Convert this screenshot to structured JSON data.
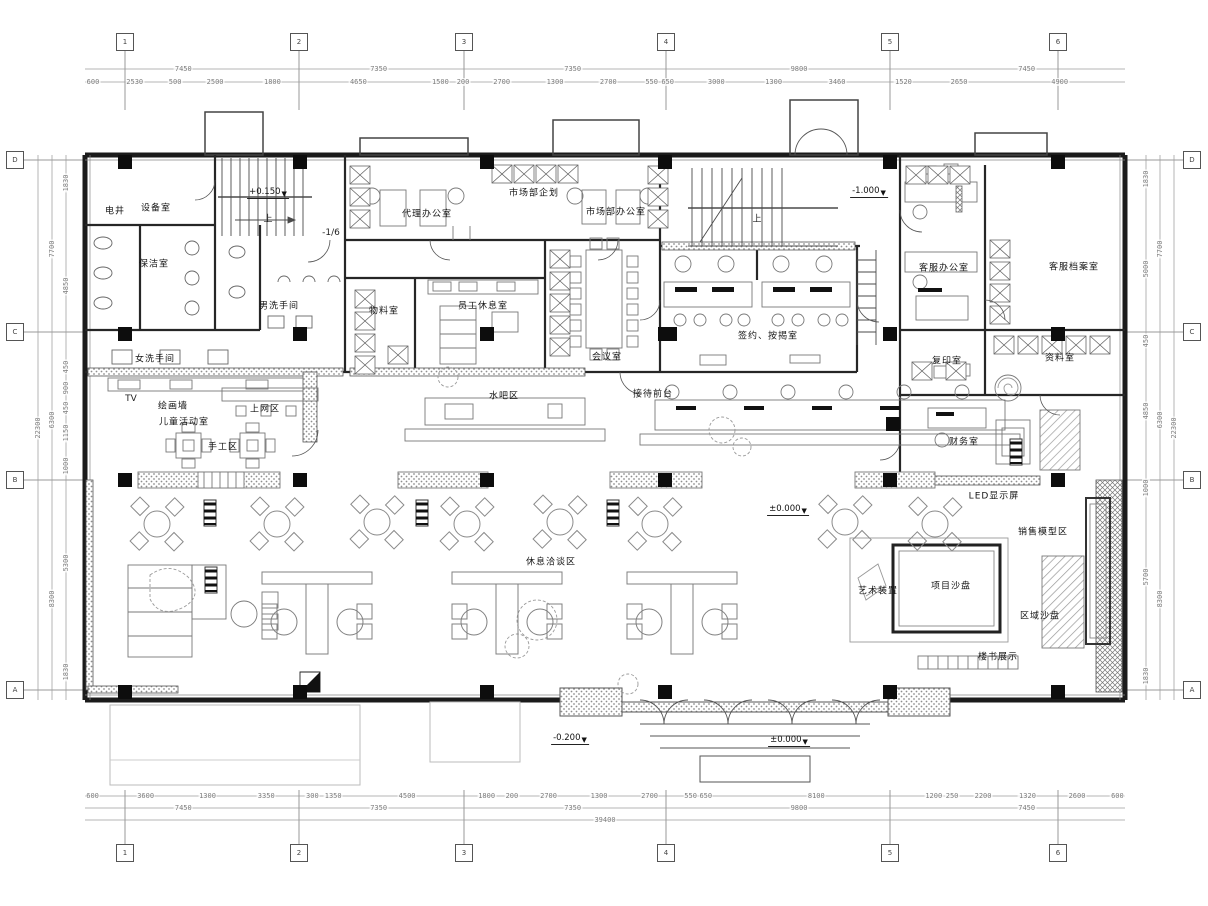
{
  "symbols": {
    "elevation_marker": "▼"
  },
  "rooms": [
    {
      "t": "电井",
      "x": 115,
      "y": 210
    },
    {
      "t": "设备室",
      "x": 156,
      "y": 207
    },
    {
      "t": "保洁室",
      "x": 154,
      "y": 263
    },
    {
      "t": "男洗手间",
      "x": 279,
      "y": 305
    },
    {
      "t": "女洗手间",
      "x": 155,
      "y": 358
    },
    {
      "t": "绘画墙",
      "x": 173,
      "y": 405
    },
    {
      "t": "儿童活动室",
      "x": 184,
      "y": 421
    },
    {
      "t": "上网区",
      "x": 265,
      "y": 408
    },
    {
      "t": "手工区",
      "x": 223,
      "y": 446
    },
    {
      "t": "物料室",
      "x": 384,
      "y": 310
    },
    {
      "t": "员工休息室",
      "x": 483,
      "y": 305
    },
    {
      "t": "代理办公室",
      "x": 427,
      "y": 213
    },
    {
      "t": "市场部企划",
      "x": 534,
      "y": 192
    },
    {
      "t": "市场部办公室",
      "x": 616,
      "y": 211
    },
    {
      "t": "会议室",
      "x": 607,
      "y": 356
    },
    {
      "t": "签约、按揭室",
      "x": 768,
      "y": 335
    },
    {
      "t": "客服办公室",
      "x": 944,
      "y": 267
    },
    {
      "t": "客服档案室",
      "x": 1074,
      "y": 266
    },
    {
      "t": "复印室",
      "x": 947,
      "y": 360
    },
    {
      "t": "资料室",
      "x": 1060,
      "y": 357
    },
    {
      "t": "财务室",
      "x": 964,
      "y": 441
    },
    {
      "t": "LED显示屏",
      "x": 994,
      "y": 495
    },
    {
      "t": "销售模型区",
      "x": 1043,
      "y": 531
    },
    {
      "t": "艺术装置",
      "x": 878,
      "y": 590
    },
    {
      "t": "项目沙盘",
      "x": 951,
      "y": 585
    },
    {
      "t": "区域沙盘",
      "x": 1040,
      "y": 615
    },
    {
      "t": "楼书展示",
      "x": 998,
      "y": 656
    },
    {
      "t": "水吧区",
      "x": 504,
      "y": 395
    },
    {
      "t": "接待前台",
      "x": 653,
      "y": 393
    },
    {
      "t": "休息洽谈区",
      "x": 551,
      "y": 561
    }
  ],
  "annotations": [
    {
      "t": "上",
      "x": 268,
      "y": 218
    },
    {
      "t": "上",
      "x": 757,
      "y": 218
    },
    {
      "t": "TV",
      "x": 131,
      "y": 399
    },
    {
      "t": "-1/6",
      "x": 331,
      "y": 233
    }
  ],
  "elevations": [
    {
      "t": "+0.150",
      "x": 268,
      "y": 199
    },
    {
      "t": "-1.000",
      "x": 869,
      "y": 198
    },
    {
      "t": "±0.000",
      "x": 788,
      "y": 516
    },
    {
      "t": "-0.200",
      "x": 570,
      "y": 745
    },
    {
      "t": "±0.000",
      "x": 789,
      "y": 747
    }
  ],
  "dimensions": {
    "rows": [
      {
        "id": "top-segments",
        "dir": "h",
        "x": 85,
        "y": 82,
        "len": 1040,
        "values": [
          600,
          2530,
          500,
          2500,
          1800,
          4650,
          1500,
          200,
          2700,
          1300,
          2700,
          550,
          650,
          3000,
          1300,
          3460,
          1520,
          2650,
          4900
        ]
      },
      {
        "id": "top-bays",
        "dir": "h",
        "x": 85,
        "y": 69,
        "len": 1040,
        "values": [
          7450,
          7350,
          7350,
          9800,
          7450
        ]
      },
      {
        "id": "bottom-segments",
        "dir": "h",
        "x": 85,
        "y": 796,
        "len": 1040,
        "values": [
          600,
          3600,
          1300,
          3350,
          300,
          1350,
          4500,
          1800,
          200,
          2700,
          1300,
          2700,
          550,
          650,
          8100,
          1200,
          250,
          2200,
          1320,
          2600,
          600
        ]
      },
      {
        "id": "bottom-bays",
        "dir": "h",
        "x": 85,
        "y": 808,
        "len": 1040,
        "values": [
          7450,
          7350,
          7350,
          9800,
          7450
        ]
      },
      {
        "id": "bottom-total",
        "dir": "h",
        "x": 85,
        "y": 820,
        "len": 1040,
        "values": [
          39400
        ]
      },
      {
        "id": "left-segments",
        "dir": "v",
        "x": 66,
        "y": 155,
        "len": 545,
        "values": [
          1830,
          4850,
          450,
          900,
          450,
          1150,
          1000,
          5300,
          1830
        ]
      },
      {
        "id": "left-bays",
        "dir": "v",
        "x": 52,
        "y": 155,
        "len": 545,
        "values": [
          7700,
          6300,
          8300
        ]
      },
      {
        "id": "left-total",
        "dir": "v",
        "x": 38,
        "y": 155,
        "len": 545,
        "values": [
          22300
        ]
      },
      {
        "id": "right-segments",
        "dir": "v",
        "x": 1146,
        "y": 155,
        "len": 545,
        "values": [
          1830,
          5000,
          450,
          4850,
          1000,
          5700,
          1830
        ]
      },
      {
        "id": "right-bays",
        "dir": "v",
        "x": 1160,
        "y": 155,
        "len": 545,
        "values": [
          7700,
          6300,
          8300
        ]
      },
      {
        "id": "right-total",
        "dir": "v",
        "x": 1174,
        "y": 155,
        "len": 545,
        "values": [
          22300
        ]
      }
    ]
  },
  "grid": {
    "rows": [
      {
        "id": "axes-top",
        "y": 42,
        "xs": [
          125,
          299,
          464,
          666,
          890,
          1058
        ],
        "labels": [
          "1",
          "2",
          "3",
          "4",
          "5",
          "6"
        ]
      },
      {
        "id": "axes-bottom",
        "y": 853,
        "xs": [
          125,
          299,
          464,
          666,
          890,
          1058
        ],
        "labels": [
          "1",
          "2",
          "3",
          "4",
          "5",
          "6"
        ]
      },
      {
        "id": "axes-left",
        "x": 15,
        "ys": [
          160,
          332,
          480,
          690
        ],
        "labels": [
          "D",
          "C",
          "B",
          "A"
        ]
      },
      {
        "id": "axes-right",
        "x": 1192,
        "ys": [
          160,
          332,
          480,
          690
        ],
        "labels": [
          "D",
          "C",
          "B",
          "A"
        ]
      }
    ]
  }
}
